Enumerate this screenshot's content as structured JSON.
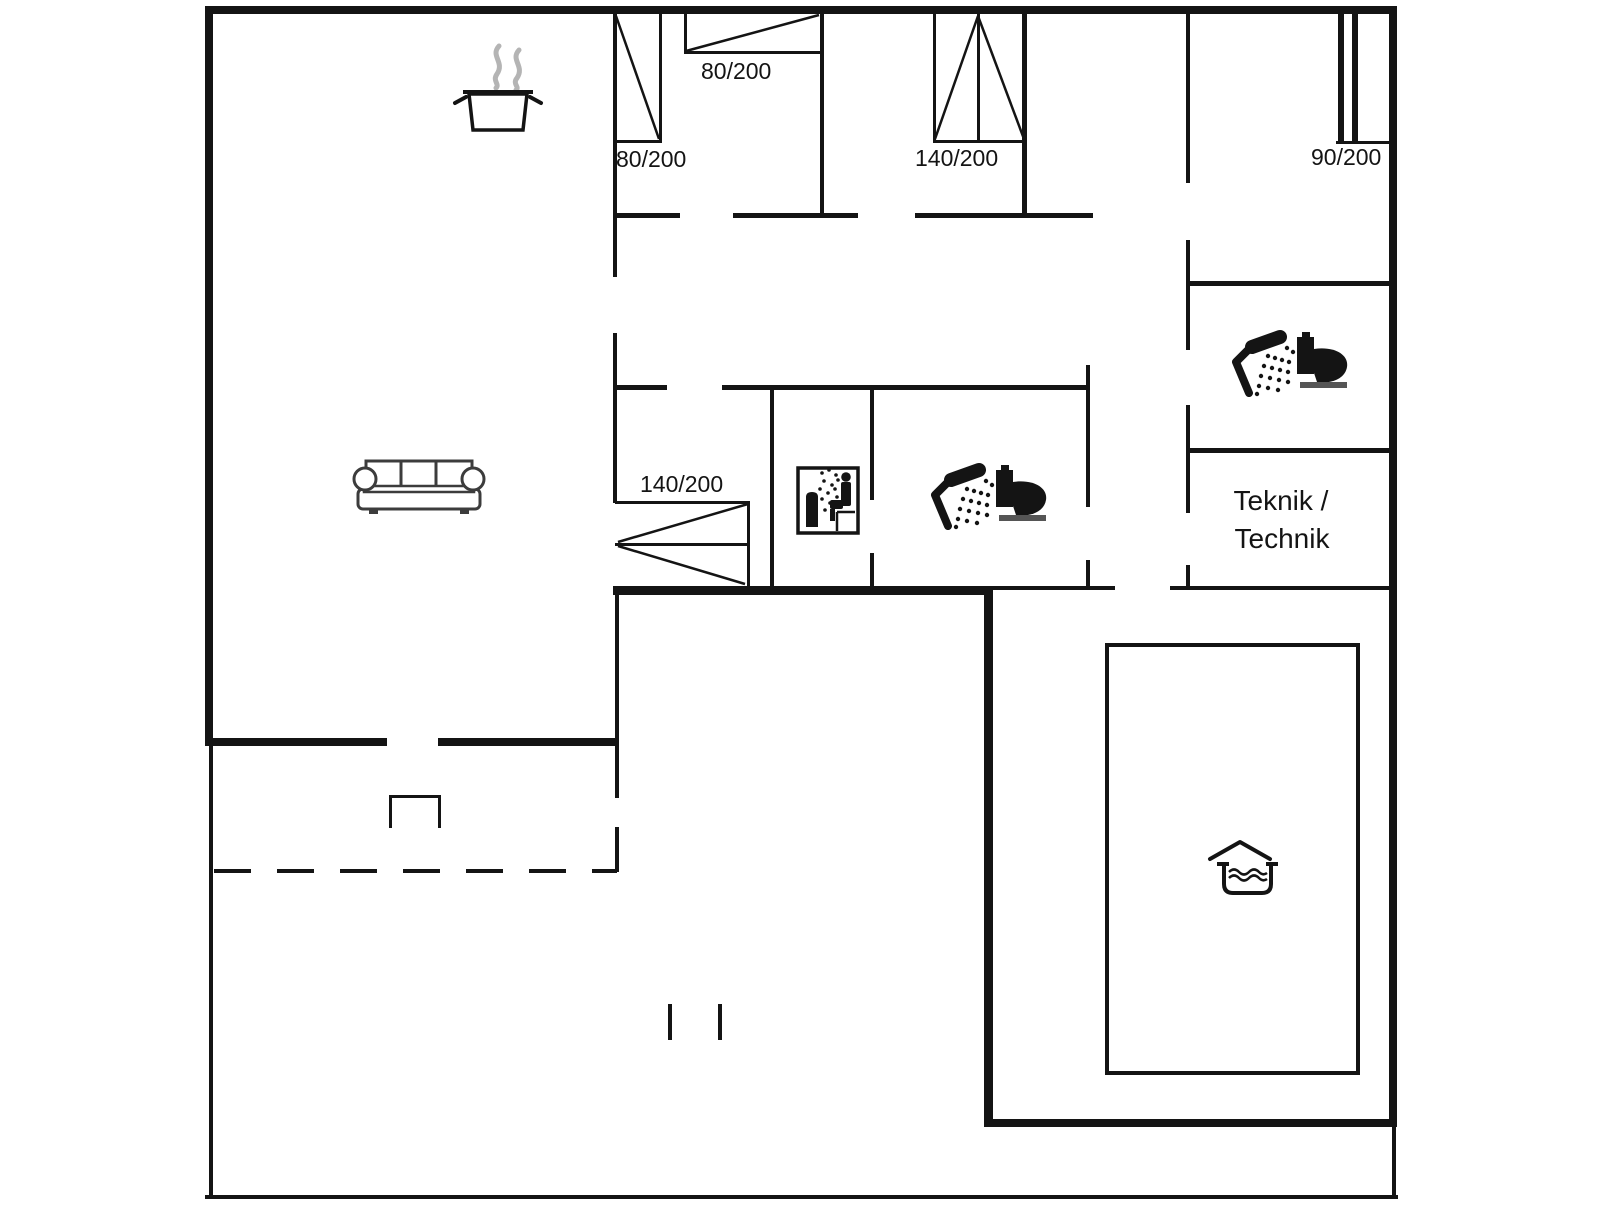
{
  "plan": {
    "title": "holiday-house-floor-plan",
    "dimension_labels": {
      "bedroom1_door": "80/200",
      "bedroom1_top_door": "80/200",
      "bedroom2_window": "140/200",
      "bedroom3_sliding_door": "90/200",
      "living_room_double_door": "140/200"
    },
    "room_labels": {
      "technics_line1": "Teknik /",
      "technics_line2": "Technik"
    },
    "icons": [
      "cooking-pot-icon",
      "steam-icon",
      "sofa-icon",
      "double-swing-door-icon",
      "sauna-icon",
      "shower-icon",
      "toilet-icon",
      "shower-icon",
      "toilet-icon",
      "pool-icon",
      "terrace-dashed-boundary",
      "terrace-posts"
    ],
    "colors": {
      "line": "#141414",
      "steam": "#b4b4b4",
      "sofa_outline": "#3c3c3c",
      "toilet_base": "#555555",
      "background": "#ffffff"
    }
  }
}
